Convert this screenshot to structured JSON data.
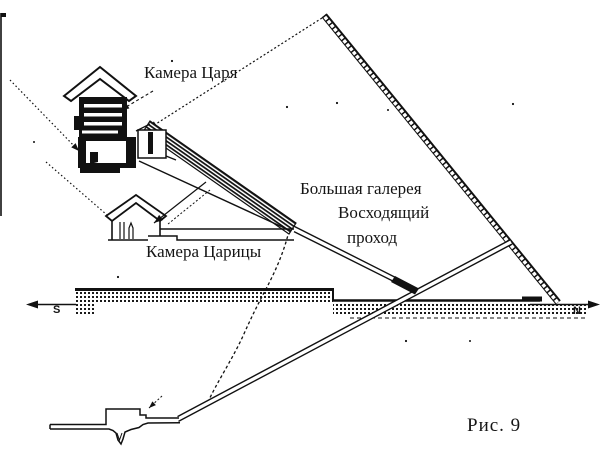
{
  "figure": {
    "caption": "Рис. 9",
    "compass": {
      "south": "S",
      "north": "N"
    },
    "labels": {
      "kings_chamber": "Камера Царя",
      "queens_chamber": "Камера Царицы",
      "grand_gallery": "Большая галерея",
      "ascending_passage_line1": "Восходящий",
      "ascending_passage_line2": "проход"
    },
    "colors": {
      "ink": "#151515",
      "paper": "#ffffff"
    }
  }
}
